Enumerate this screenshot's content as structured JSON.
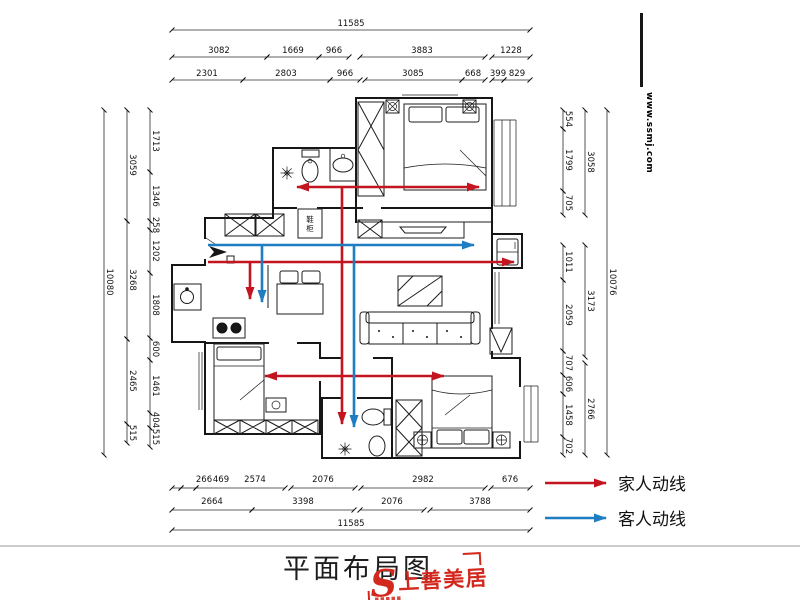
{
  "page": {
    "title": "平面布局图",
    "watermark": "www.ssmj.com"
  },
  "legend": {
    "family": {
      "label": "家人动线",
      "color": "#c41420"
    },
    "guest": {
      "label": "客人动线",
      "color": "#1f7ec2"
    }
  },
  "logo": {
    "name": "上善美居",
    "mark": "S",
    "color": "#d3281e"
  },
  "plan": {
    "entry_cabinet_chars": [
      "鞋",
      "柜"
    ]
  },
  "dims": {
    "top": {
      "total": "11585",
      "row2": [
        "3082",
        "1669",
        "966",
        "3883",
        "1228"
      ],
      "row3": [
        "2301",
        "2803",
        "966",
        "3085",
        "668",
        "399",
        "829"
      ]
    },
    "bottom": {
      "row1": [
        "266",
        "469",
        "2574",
        "2076",
        "2982",
        "676"
      ],
      "row2": [
        "2664",
        "3398",
        "2076",
        "3788"
      ],
      "total": "11585"
    },
    "left": {
      "total": "10080",
      "mid": [
        "3059",
        "3268",
        "2465",
        "515"
      ],
      "inner": [
        "1713",
        "1346",
        "258",
        "1202",
        "1808",
        "600",
        "1461",
        "404",
        "515"
      ]
    },
    "right": {
      "total": "10076",
      "mid": [
        "3058",
        "3173",
        "2766"
      ],
      "inner": [
        "554",
        "1799",
        "705",
        "1011",
        "2059",
        "707",
        "606",
        "1458",
        "702"
      ]
    }
  }
}
